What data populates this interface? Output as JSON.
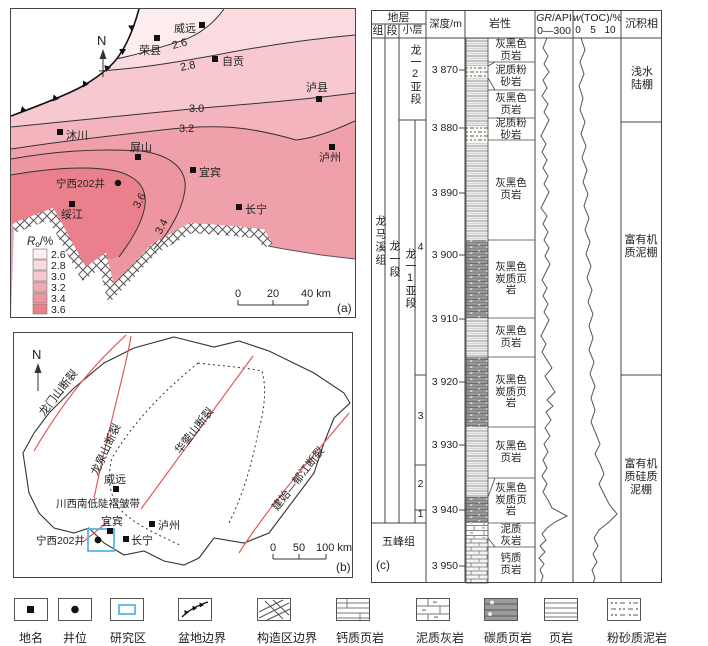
{
  "figure": {
    "panel_a_label": "(a)",
    "panel_b_label": "(b)",
    "panel_c_label": "(c)"
  },
  "panel_a": {
    "north": "N",
    "cities": [
      {
        "name": "威远"
      },
      {
        "name": "荣县"
      },
      {
        "name": "自贡"
      },
      {
        "name": "泸县"
      },
      {
        "name": "沐川"
      },
      {
        "name": "屏山"
      },
      {
        "name": "宜宾"
      },
      {
        "name": "泸州"
      },
      {
        "name": "长宁"
      },
      {
        "name": "绥江"
      }
    ],
    "well": "宁西202井",
    "contours": {
      "c26": "2.6",
      "c28": "2.8",
      "c30": "3.0",
      "c32": "3.2",
      "c34": "3.4",
      "c36": "3.6"
    },
    "legend": {
      "title_r": "R",
      "title_sub": "o",
      "title_unit": "/%",
      "items": [
        {
          "value": "2.6",
          "color": "#fdedef"
        },
        {
          "value": "2.8",
          "color": "#fadbe0"
        },
        {
          "value": "3.0",
          "color": "#f7c8cf"
        },
        {
          "value": "3.2",
          "color": "#f2aab4"
        },
        {
          "value": "3.4",
          "color": "#ee96a0"
        },
        {
          "value": "3.6",
          "color": "#ea808c"
        }
      ]
    },
    "scale": {
      "t0": "0",
      "t1": "20",
      "t2": "40 km"
    }
  },
  "panel_b": {
    "north": "N",
    "faults": [
      {
        "name": "龙门山断裂"
      },
      {
        "name": "龙泉山断裂"
      },
      {
        "name": "华蓥山断裂"
      },
      {
        "name": "建始—郁江断裂"
      }
    ],
    "fold_belt": "川西南低陡褶皱带",
    "cities": [
      {
        "name": "威远"
      },
      {
        "name": "宜宾"
      },
      {
        "name": "泸州"
      },
      {
        "name": "长宁"
      }
    ],
    "well": "宁西202井",
    "scale": {
      "t0": "0",
      "t1": "50",
      "t2": "100 km"
    }
  },
  "panel_c": {
    "header": {
      "stratum": "地层",
      "group_col": "组",
      "member_col": "段",
      "sublayer_col": "小层",
      "depth": "深度/m",
      "lithology": "岩性",
      "gr_i": "GR",
      "gr_rest": "/API",
      "gr_range": "0—300",
      "toc_i": "w",
      "toc_rest": "(TOC)/%",
      "toc_t0": "0",
      "toc_t5": "5",
      "toc_t10": "10",
      "facies": "沉积相"
    },
    "group1": "龙马溪组",
    "group2": "五峰组",
    "member": "龙一段",
    "submember2": "龙一2亚段",
    "submember1": "龙一1亚段",
    "sublayers": [
      {
        "n": "4"
      },
      {
        "n": "3"
      },
      {
        "n": "2"
      },
      {
        "n": "1"
      }
    ],
    "depths": [
      {
        "v": "3 870"
      },
      {
        "v": "3 880"
      },
      {
        "v": "3 890"
      },
      {
        "v": "3 900"
      },
      {
        "v": "3 910"
      },
      {
        "v": "3 920"
      },
      {
        "v": "3 930"
      },
      {
        "v": "3 940"
      },
      {
        "v": "3 950"
      }
    ],
    "lith": [
      {
        "text": "灰黑色页岩"
      },
      {
        "text": "泥质粉砂岩"
      },
      {
        "text": "灰黑色页岩"
      },
      {
        "text": "泥质粉砂岩"
      },
      {
        "text": "灰黑色页岩"
      },
      {
        "text": "灰黑色炭质页岩"
      },
      {
        "text": "灰黑色页岩"
      },
      {
        "text": "灰黑色炭质页岩"
      },
      {
        "text": "灰黑色页岩"
      },
      {
        "text": "灰黑色炭质页岩"
      },
      {
        "text": "泥质灰岩"
      },
      {
        "text": "钙质页岩"
      }
    ],
    "facies_zones": [
      {
        "text": "浅水陆棚"
      },
      {
        "text": "富有机质泥棚"
      },
      {
        "text": "富有机质硅质泥棚"
      }
    ]
  },
  "legend_row": {
    "items": [
      {
        "label": "地名"
      },
      {
        "label": "井位"
      },
      {
        "label": "研究区"
      },
      {
        "label": "盆地边界"
      },
      {
        "label": "构造区边界"
      },
      {
        "label": "钙质页岩"
      },
      {
        "label": "泥质灰岩"
      },
      {
        "label": "碳质页岩"
      },
      {
        "label": "页岩"
      },
      {
        "label": "粉砂质泥岩"
      }
    ]
  }
}
